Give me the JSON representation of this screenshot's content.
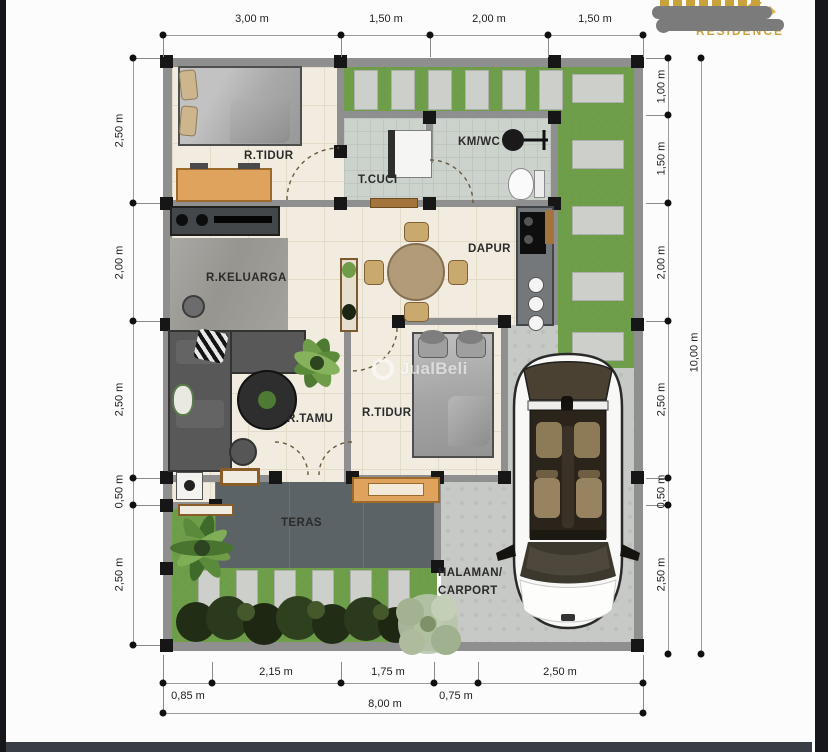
{
  "branding": {
    "residence_text": "RESIDENCE",
    "note": "brand name redacted with gray blobs",
    "gold": "#c8a23a"
  },
  "watermark": {
    "text": "JualBeli"
  },
  "plan": {
    "labels": {
      "bedroom1": "R.TIDUR",
      "laundry": "T.CUCI",
      "bathroom": "KM/WC",
      "kitchen": "DAPUR",
      "family_room": "R.KELUARGA",
      "living_room": "R.TAMU",
      "bedroom2": "R.TIDUR",
      "terrace": "TERAS",
      "yard_line1": "HALAMAN/",
      "yard_line2": "CARPORT"
    },
    "dimensions": {
      "top": [
        "3,00 m",
        "1,50 m",
        "2,00 m",
        "1,50 m"
      ],
      "left": [
        "2,50 m",
        "2,00 m",
        "2,50 m",
        "0,50 m",
        "2,50 m"
      ],
      "right": [
        "1,00 m",
        "1,50 m",
        "2,00 m",
        "2,50 m",
        "0,50 m",
        "2,50 m"
      ],
      "right_overall": "10,00 m",
      "bottom": [
        "0,85 m",
        "2,15 m",
        "1,75 m",
        "0,75 m",
        "2,50 m"
      ],
      "bottom_overall": "8,00 m"
    },
    "colors": {
      "grass": "#6f9e4b",
      "floor_cream": "#f1ecdf",
      "wet_floor": "#ccd2cc",
      "wall_gray": "#8f8f8f",
      "terrace_slab": "#5b6366",
      "carport_concrete": "#c6c9c5",
      "accent_wood": "#e0a35e"
    }
  }
}
